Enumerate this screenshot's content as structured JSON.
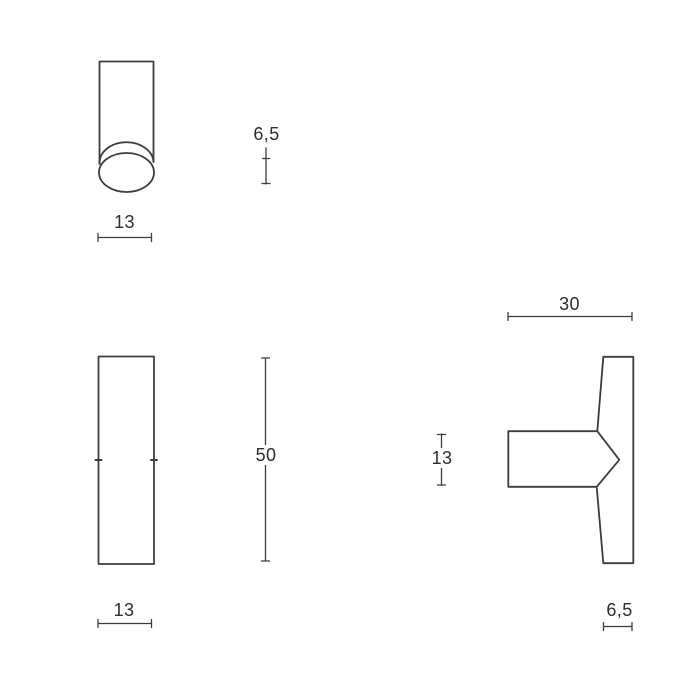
{
  "drawing": {
    "type": "technical-dimension-drawing",
    "subject": "T-shaped knob / handle, three orthographic views",
    "background_color": "#ffffff",
    "line_color": "#3d3d3d",
    "text_color": "#2d2d2d",
    "views": [
      {
        "id": "top-view",
        "description": "cylinder with domed end, seen from front-top"
      },
      {
        "id": "front-view",
        "description": "tall rectangular bar face"
      },
      {
        "id": "side-view",
        "description": "T-profile with conical neck joint"
      }
    ],
    "dimensions": {
      "top_view_width": {
        "value": "13",
        "orientation": "horizontal"
      },
      "dome_height": {
        "value": "6,5",
        "orientation": "vertical"
      },
      "front_view_height": {
        "value": "50",
        "orientation": "vertical"
      },
      "front_view_width": {
        "value": "13",
        "orientation": "horizontal"
      },
      "side_view_depth": {
        "value": "30",
        "orientation": "horizontal"
      },
      "neck_height": {
        "value": "13",
        "orientation": "vertical"
      },
      "edge_thickness": {
        "value": "6,5",
        "orientation": "horizontal"
      }
    }
  }
}
